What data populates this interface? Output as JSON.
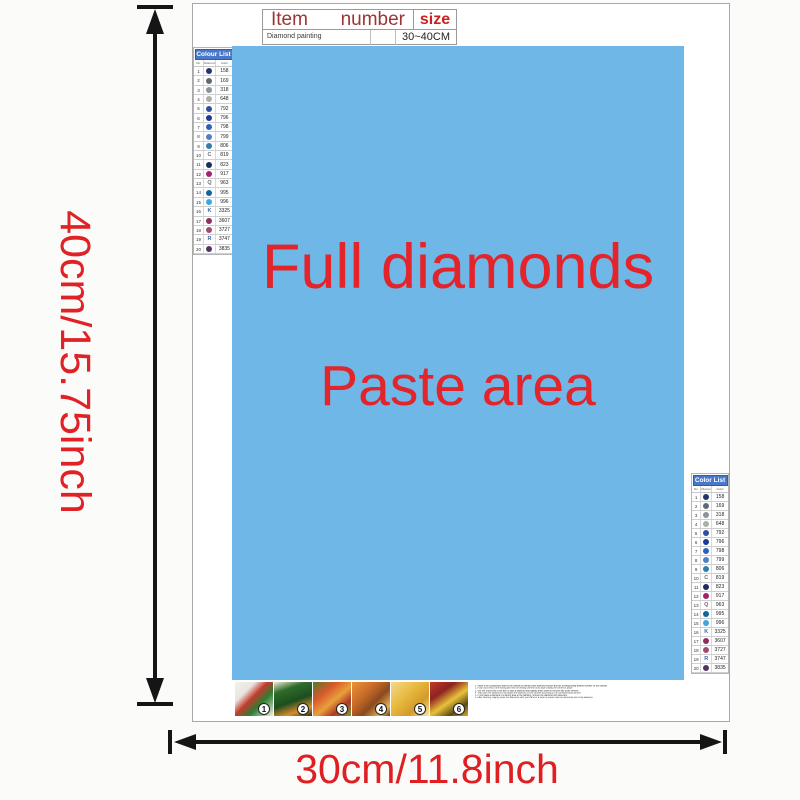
{
  "dimension_labels": {
    "height": "40cm/15.75inch",
    "width": "30cm/11.8inch"
  },
  "item_table": {
    "col_item": "Item",
    "col_number": "number",
    "col_size": "size",
    "row_item": "Diamond painting",
    "row_number": "",
    "row_size": "30~40CM"
  },
  "paste_area": {
    "line1": "Full diamonds",
    "line2": "Paste area",
    "bg_color": "#6fb7e6",
    "text_color": "#e3242b"
  },
  "color_list": {
    "title_left": "Colour List",
    "title_right": "Color List",
    "col_no": "No.",
    "col_symbol": "Diamond",
    "col_color": "Color",
    "rows": [
      {
        "no": "1",
        "glyph": "",
        "glyph_color": "",
        "dot": "#26356e",
        "code": "158"
      },
      {
        "no": "2",
        "glyph": "",
        "glyph_color": "",
        "dot": "#5f6a72",
        "code": "169"
      },
      {
        "no": "3",
        "glyph": "",
        "glyph_color": "",
        "dot": "#8d9399",
        "code": "318"
      },
      {
        "no": "4",
        "glyph": "",
        "glyph_color": "",
        "dot": "#aab0a8",
        "code": "648"
      },
      {
        "no": "5",
        "glyph": "",
        "glyph_color": "",
        "dot": "#30509f",
        "code": "792"
      },
      {
        "no": "6",
        "glyph": "",
        "glyph_color": "",
        "dot": "#1d3a9a",
        "code": "796"
      },
      {
        "no": "7",
        "glyph": "",
        "glyph_color": "",
        "dot": "#2e62b8",
        "code": "798"
      },
      {
        "no": "8",
        "glyph": "",
        "glyph_color": "",
        "dot": "#4f7fc9",
        "code": "799"
      },
      {
        "no": "9",
        "glyph": "",
        "glyph_color": "",
        "dot": "#2e7fae",
        "code": "806"
      },
      {
        "no": "10",
        "glyph": "C",
        "glyph_color": "#6b6b6b",
        "dot": "",
        "code": "819"
      },
      {
        "no": "11",
        "glyph": "",
        "glyph_color": "",
        "dot": "#1c2c5e",
        "code": "823"
      },
      {
        "no": "12",
        "glyph": "",
        "glyph_color": "",
        "dot": "#a3246d",
        "code": "917"
      },
      {
        "no": "13",
        "glyph": "Q",
        "glyph_color": "#6b6b6b",
        "dot": "",
        "code": "963"
      },
      {
        "no": "14",
        "glyph": "",
        "glyph_color": "",
        "dot": "#14659f",
        "code": "995"
      },
      {
        "no": "15",
        "glyph": "",
        "glyph_color": "",
        "dot": "#3ea6de",
        "code": "996"
      },
      {
        "no": "16",
        "glyph": "K",
        "glyph_color": "#3b64ae",
        "dot": "",
        "code": "3325"
      },
      {
        "no": "17",
        "glyph": "",
        "glyph_color": "",
        "dot": "#8e2f5d",
        "code": "3607"
      },
      {
        "no": "18",
        "glyph": "",
        "glyph_color": "",
        "dot": "#a34b6e",
        "code": "3727"
      },
      {
        "no": "19",
        "glyph": "R",
        "glyph_color": "#3b64ae",
        "dot": "",
        "code": "3747"
      },
      {
        "no": "20",
        "glyph": "",
        "glyph_color": "",
        "dot": "#523368",
        "code": "3835"
      }
    ]
  },
  "steps": [
    "1",
    "2",
    "3",
    "4",
    "5",
    "6"
  ],
  "instructions": {
    "lines": [
      "1. Paste it the composition area to the canvas to identify each diamond symbol and the corresponding printed number on the canvas.",
      "2. Hold round end of the testing pen first the testing cement round tack it away the cement it place.",
      "3. Use the round end of the pen to stick a diamond and slightly press down to remove any loose cement.",
      "4. Tear open the special film and place the diamond on the canvas according to the corresponding number.",
      "5. If you place a diamond in a wrong area of the painting, remove the diamond with tweezers.",
      "6. After finishing, slightly press the diamonds with your hand or a book to ensure that the diamonds are firmly attached."
    ]
  }
}
